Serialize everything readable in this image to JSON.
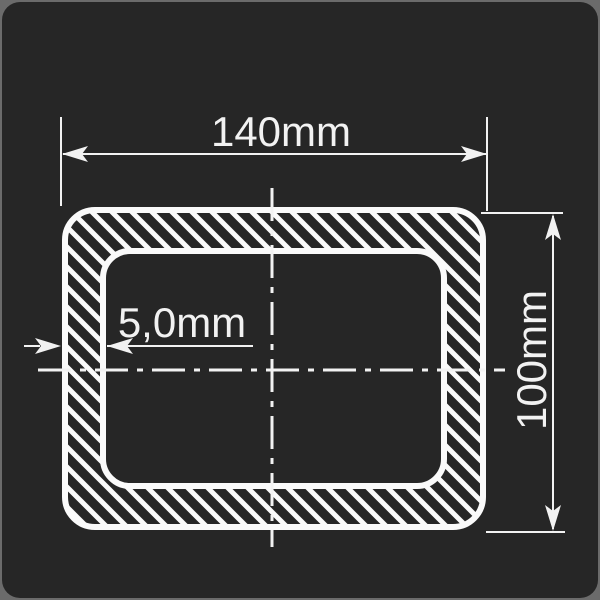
{
  "drawing": {
    "type": "cross-section",
    "shape": "rectangular-hollow-section",
    "units": "mm",
    "outer_width_mm": 140,
    "outer_height_mm": 100,
    "wall_thickness_mm": 5.0,
    "labels": {
      "width": "140mm",
      "height": "100mm",
      "thickness": "5,0mm"
    },
    "line_style": {
      "centerline": "dash-dot",
      "hatch": "diagonal-45deg"
    },
    "colors": {
      "page_background": "#6b6b6b",
      "card_background": "#262626",
      "line": "#f2f2f2",
      "hatch": "#fafafa"
    }
  }
}
